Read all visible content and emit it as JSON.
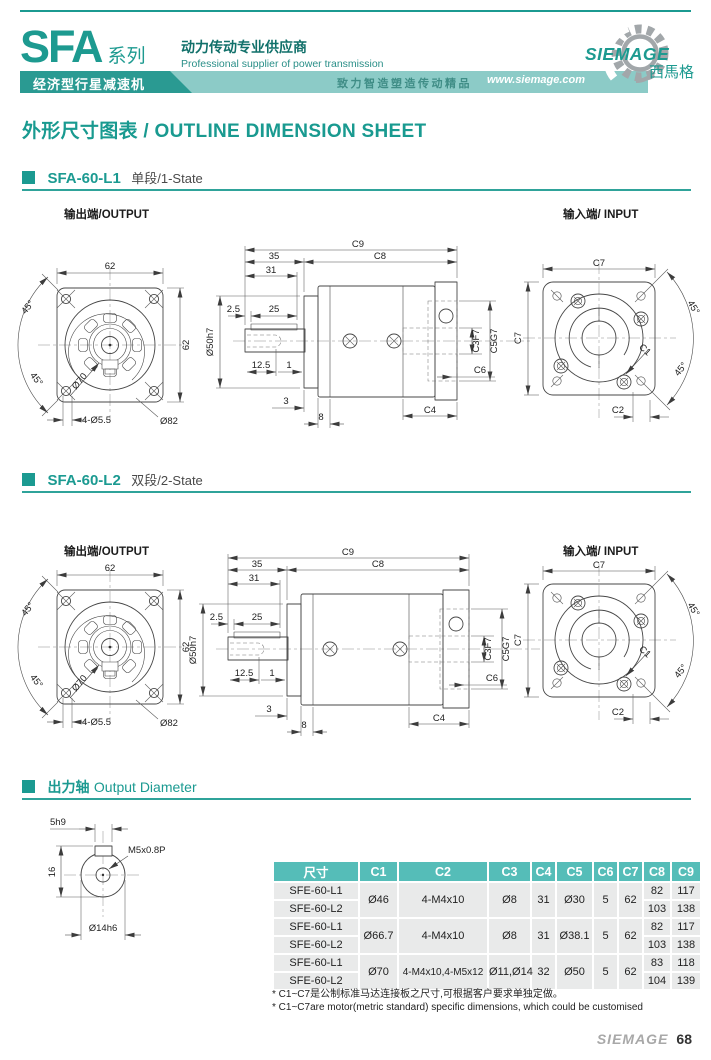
{
  "header": {
    "series": "SFA",
    "series_suffix": "系列",
    "supplier_cn": "动力传动专业供应商",
    "supplier_en": "Professional supplier of power transmission",
    "product_type": "经济型行星减速机",
    "slogan": "致力智造塑造传动精品",
    "website": "www.siemage.com",
    "brand": "SIEMAGE",
    "brand_cn": "西馬格"
  },
  "page_title": "外形尺寸图表 / OUTLINE DIMENSION SHEET",
  "sections": {
    "s1": {
      "title": "SFA-60-L1",
      "subtitle": "单段/1-State",
      "output_label": "输出端/OUTPUT",
      "input_label": "输入端/ INPUT"
    },
    "s2": {
      "title": "SFA-60-L2",
      "subtitle": "双段/2-State",
      "output_label": "输出端/OUTPUT",
      "input_label": "输入端/ INPUT"
    },
    "s3": {
      "title_cn": "出力轴",
      "title_en": "Output Diameter"
    }
  },
  "dims": {
    "flange_out": {
      "w": "62",
      "h": "62",
      "a1": "45°",
      "a2": "45°",
      "d70": "Ø70",
      "holes": "4-Ø5.5",
      "d82": "Ø82"
    },
    "side": {
      "c9": "C9",
      "c8": "C8",
      "l35": "35",
      "l31": "31",
      "l25": "25",
      "l2_5": "2.5",
      "d50": "Ø50h7",
      "l12_5": "12.5",
      "l1": "1",
      "l3": "3",
      "l8": "8",
      "c3": "C3F7",
      "c5": "C5G7",
      "c6": "C6",
      "c4": "C4"
    },
    "flange_in": {
      "c7": "C7",
      "a1": "45°",
      "a2": "45°",
      "c1": "C1",
      "c2": "C2"
    },
    "shaft": {
      "key": "5h9",
      "h16": "16",
      "tap": "M5x0.8P",
      "d14": "Ø14h6"
    }
  },
  "table": {
    "headers": [
      "尺寸",
      "C1",
      "C2",
      "C3",
      "C4",
      "C5",
      "C6",
      "C7",
      "C8",
      "C9"
    ],
    "groups": [
      {
        "c1": "Ø46",
        "c2": "4-M4x10",
        "c3": "Ø8",
        "c4": "31",
        "c5": "Ø30",
        "c6": "5",
        "c7": "62",
        "rows": [
          {
            "name": "SFE-60-L1",
            "c8": "82",
            "c9": "117"
          },
          {
            "name": "SFE-60-L2",
            "c8": "103",
            "c9": "138"
          }
        ]
      },
      {
        "c1": "Ø66.7",
        "c2": "4-M4x10",
        "c3": "Ø8",
        "c4": "31",
        "c5": "Ø38.1",
        "c6": "5",
        "c7": "62",
        "rows": [
          {
            "name": "SFE-60-L1",
            "c8": "82",
            "c9": "117"
          },
          {
            "name": "SFE-60-L2",
            "c8": "103",
            "c9": "138"
          }
        ]
      },
      {
        "c1": "Ø70",
        "c2": "4-M4x10,4-M5x12",
        "c3": "Ø11,Ø14",
        "c4": "32",
        "c5": "Ø50",
        "c6": "5",
        "c7": "62",
        "rows": [
          {
            "name": "SFE-60-L1",
            "c8": "83",
            "c9": "118"
          },
          {
            "name": "SFE-60-L2",
            "c8": "104",
            "c9": "139"
          }
        ]
      }
    ]
  },
  "notes": {
    "cn": "* C1~C7是公制标准马达连接板之尺寸,可根据客户要求单独定做。",
    "en": "* C1~C7are motor(metric standard)  specific dimensions, which could be customised"
  },
  "footer": {
    "brand": "SIEMAGE",
    "page": "68"
  },
  "colors": {
    "teal": "#1b9a91",
    "teal_dark": "#2a9a92",
    "band_light": "#8ccbc7",
    "table_header": "#55bdb8",
    "row_gray": "#e9eaea"
  }
}
